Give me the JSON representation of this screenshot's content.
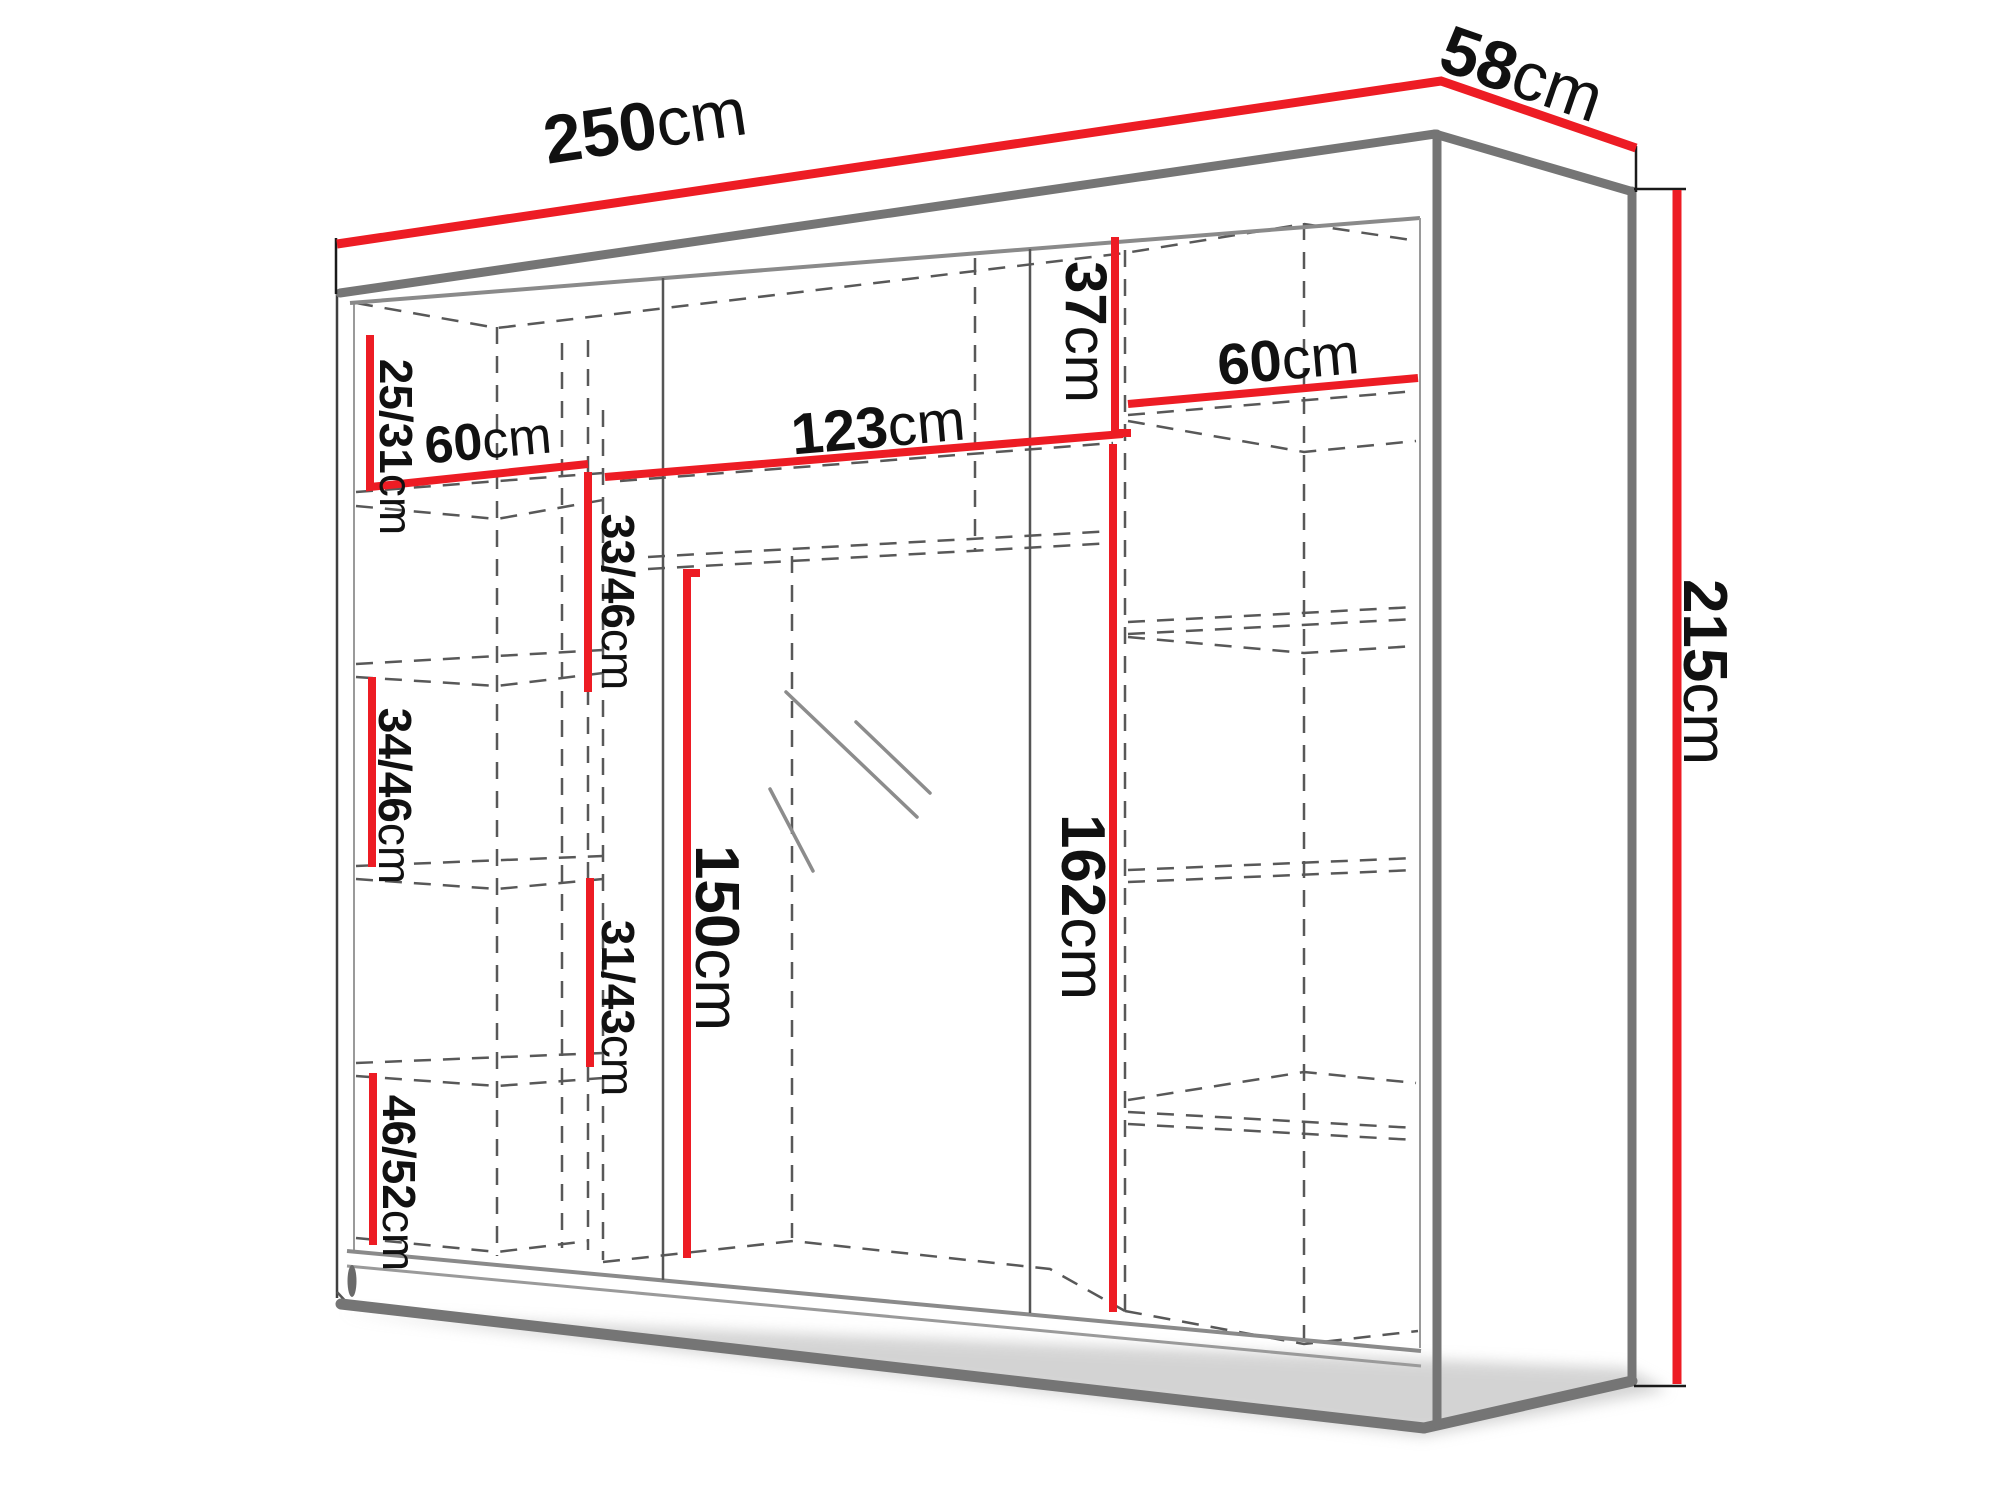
{
  "diagram": {
    "kind": "wardrobe-dimension-diagram",
    "colors": {
      "dimension_line_red": "#ed1c24",
      "edge_gray": "#757575",
      "dashed_gray": "#585858",
      "text_black": "#111111",
      "background": "#ffffff"
    }
  },
  "labels": {
    "w250": {
      "value": "250",
      "unit": "cm"
    },
    "d58": {
      "value": "58",
      "unit": "cm"
    },
    "h215": {
      "value": "215",
      "unit": "cm"
    },
    "s2531": {
      "value": "25/31",
      "unit": "cm"
    },
    "w60l": {
      "value": "60",
      "unit": "cm"
    },
    "s3346": {
      "value": "33/46",
      "unit": "cm"
    },
    "s3446": {
      "value": "34/46",
      "unit": "cm"
    },
    "s3143": {
      "value": "31/43",
      "unit": "cm"
    },
    "s4652": {
      "value": "46/52",
      "unit": "cm"
    },
    "w123": {
      "value": "123",
      "unit": "cm"
    },
    "h37": {
      "value": "37",
      "unit": "cm"
    },
    "w60r": {
      "value": "60",
      "unit": "cm"
    },
    "h150": {
      "value": "150",
      "unit": "cm"
    },
    "h162": {
      "value": "162",
      "unit": "cm"
    }
  }
}
